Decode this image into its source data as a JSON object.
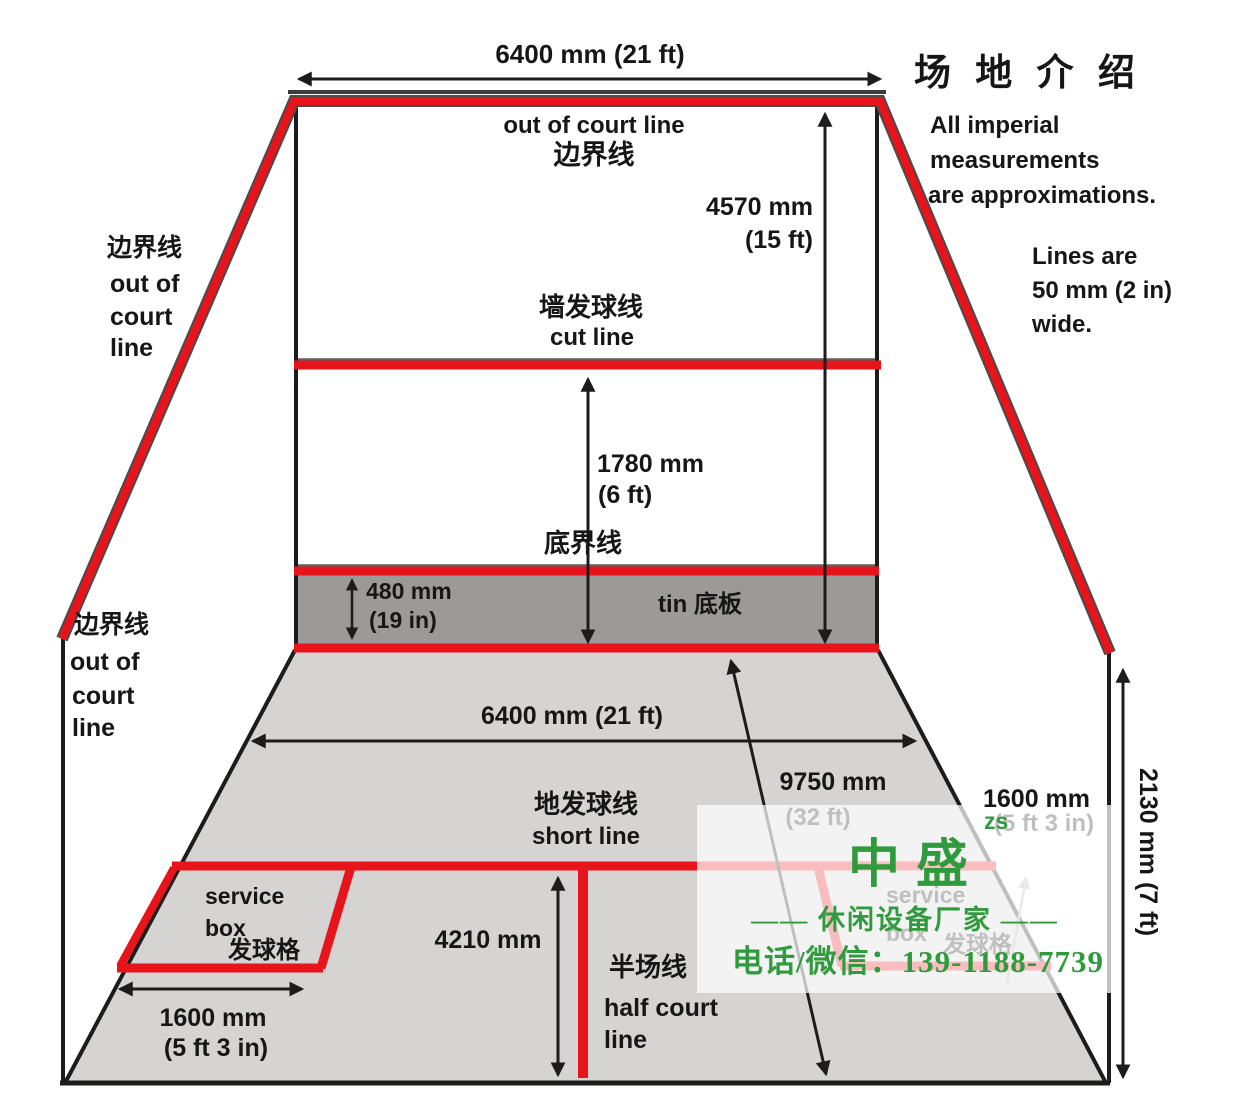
{
  "header": {
    "top_width": "6400 mm (21 ft)",
    "title": "场 地 介 绍"
  },
  "notes": {
    "imperial1": "All imperial",
    "imperial2": "measurements",
    "imperial3": "are approximations.",
    "lines1": "Lines are",
    "lines2": "50 mm (2 in)",
    "lines3": "wide."
  },
  "front_wall": {
    "out_line_en": "out of court line",
    "out_line_zh": "边界线",
    "height_mm": "4570 mm",
    "height_ft": "(15 ft)",
    "cut_zh": "墙发球线",
    "cut_en": "cut line",
    "cut_height_mm": "1780 mm",
    "cut_height_ft": "(6 ft)",
    "board_zh": "底界线",
    "tin_label": "tin 底板",
    "tin_mm": "480 mm",
    "tin_in": "(19 in)"
  },
  "side_labels": {
    "upper": [
      "边界线",
      "out of",
      "court",
      "line"
    ],
    "lower": [
      "边界线",
      "out of",
      "court",
      "line"
    ]
  },
  "floor": {
    "width": "6400 mm (21 ft)",
    "length_mm": "9750 mm",
    "length_ft": "(32 ft)",
    "short_zh": "地发球线",
    "short_en": "short line",
    "svc1": "service",
    "svc2": "box",
    "svc_zh": "发球格",
    "box_mm": "1600 mm",
    "box_ft": "(5 ft 3 in)",
    "back_len": "4210 mm",
    "half_zh": "半场线",
    "half_en1": "half court",
    "half_en2": "line",
    "rbox_mm": "1600 mm",
    "rbox_ft": "(5 ft 3 in)",
    "rsvc1": "service",
    "rsvc2": "box",
    "rsvc_zh": "发球格",
    "height_back": "2130 mm (7 ft)"
  },
  "watermark": {
    "brand": "中盛",
    "brand_sub": "zs",
    "slogan": "——  休闲设备厂家  ——",
    "phone": "电话/微信：139-1188-7739"
  },
  "colors": {
    "line_red": "#e8141b",
    "watermark_green": "#2f9b3c",
    "floor_gray": "#d5d4d2",
    "tin_gray": "#9c9a98"
  }
}
